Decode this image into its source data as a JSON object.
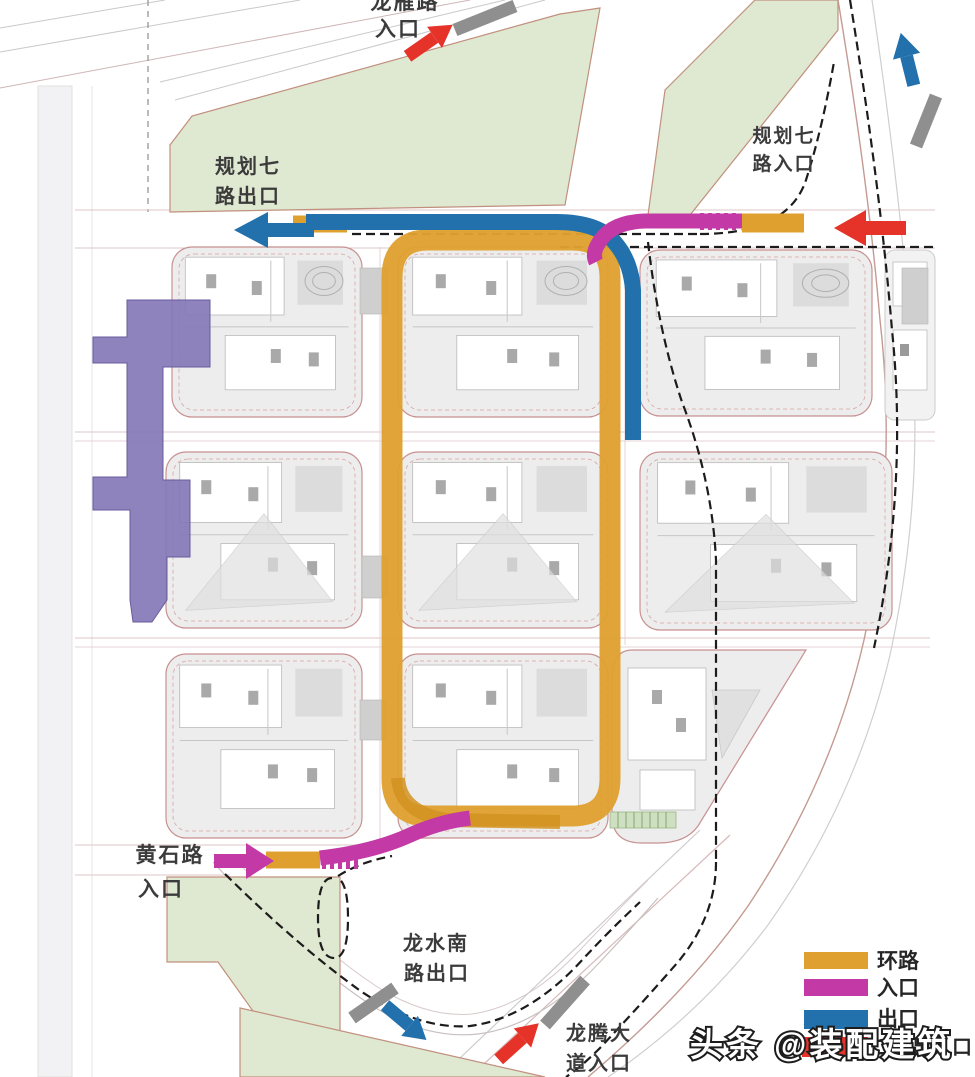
{
  "diagram": {
    "labels": {
      "top_entrance": {
        "line1": "龙雁路",
        "line2": "入口"
      },
      "northwest_exit": {
        "line1": "规划七",
        "line2": "路出口"
      },
      "northeast_entrance": {
        "line1": "规划七",
        "line2": "路入口"
      },
      "huangshi_entrance": {
        "line1": "黄石路",
        "line2": "入口"
      },
      "longshui_exit": {
        "line1": "龙水南",
        "line2": "路出口"
      },
      "longteng_entrance": {
        "line1": "龙腾大",
        "line2": "道入口"
      }
    },
    "colors": {
      "ring_road": "#DFA030",
      "ring_road_dark": "#D29322",
      "entrance_route": "#C33AA6",
      "exit_route": "#2270AC",
      "phase2_route": "#E5332A",
      "metro_corridor": "#8478B6",
      "metro_outline": "#6A5B9E",
      "green_space": "#DFE8D0",
      "green_outline": "#C1907E",
      "block_fill": "#EDEDED",
      "block_outline": "#C79191",
      "road_marker_gray": "#8F8F8F"
    },
    "legend": {
      "items": [
        {
          "label": "环路",
          "color": "#DFA030"
        },
        {
          "label": "入口",
          "color": "#C33AA6"
        },
        {
          "label": "出口",
          "color": "#2270AC"
        },
        {
          "label": "二期出入口",
          "color": "#E5332A"
        }
      ]
    },
    "watermark": "头条 @装配建筑"
  }
}
